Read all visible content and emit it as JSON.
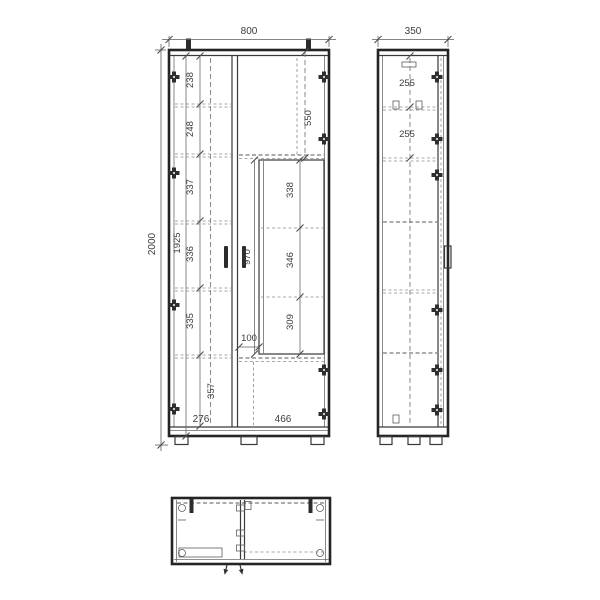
{
  "colors": {
    "line": "#2c2c2c",
    "background": "#ffffff"
  },
  "views": {
    "front": {
      "width": "800",
      "height": "2000",
      "interior_height": "1925",
      "left_sections": [
        "238",
        "248",
        "337",
        "336",
        "335"
      ],
      "plinth_height": "357",
      "left_width": "276",
      "top_door_height": "550",
      "niche_height": "970",
      "niche_sections": [
        "338",
        "346",
        "309"
      ],
      "niche_gap": "100",
      "right_width": "466"
    },
    "side": {
      "depth": "350",
      "top_sections": [
        "255",
        "255"
      ]
    }
  }
}
